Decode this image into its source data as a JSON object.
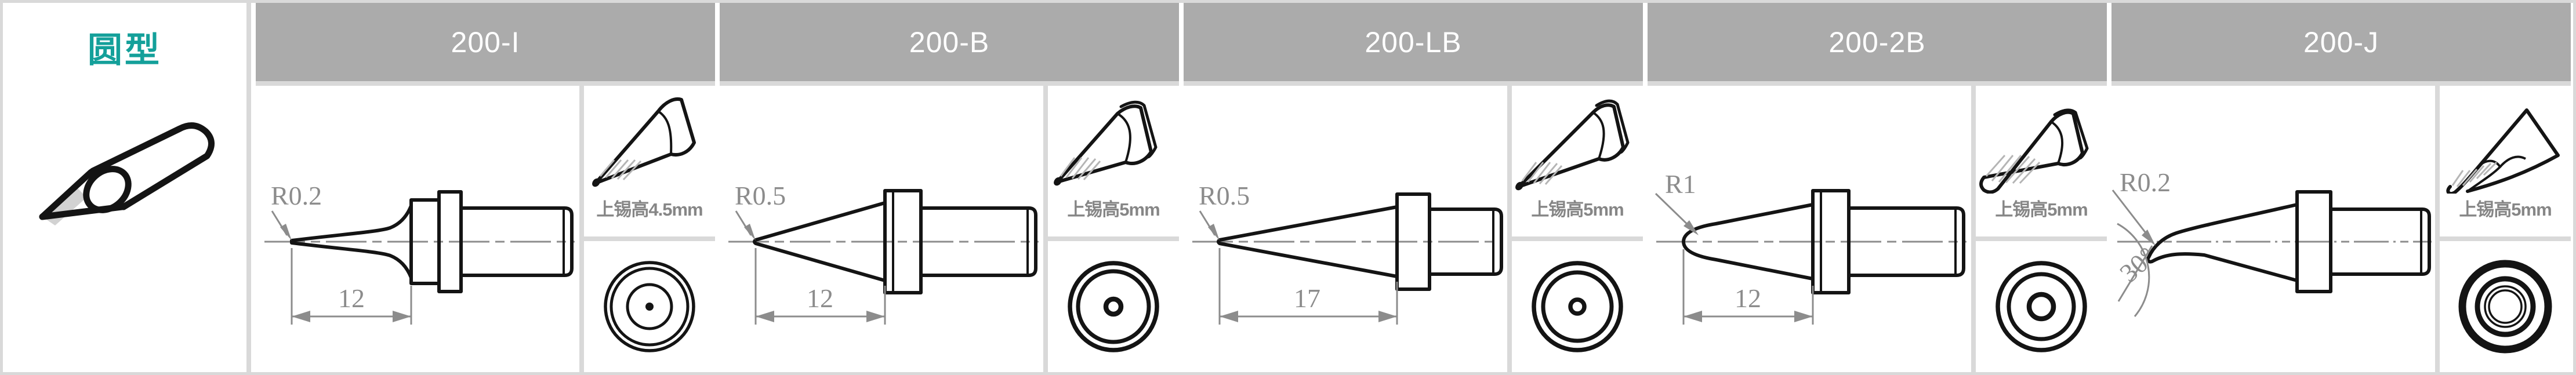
{
  "category": {
    "title": "圆型"
  },
  "colors": {
    "accent_teal": "#14a09a",
    "header_bg": "#ababab",
    "header_text": "#ffffff",
    "grid": "#d9d9d9",
    "drawing_line": "#141414",
    "annotation_gray": "#8c8c8c"
  },
  "columns": [
    {
      "model": "200-I",
      "radius_label": "R0.2",
      "length_label": "12",
      "tin_height_label": "上锡高4.5mm"
    },
    {
      "model": "200-B",
      "radius_label": "R0.5",
      "length_label": "12",
      "tin_height_label": "上锡高5mm"
    },
    {
      "model": "200-LB",
      "radius_label": "R0.5",
      "length_label": "17",
      "tin_height_label": "上锡高5mm"
    },
    {
      "model": "200-2B",
      "radius_label": "R1",
      "length_label": "12",
      "tin_height_label": "上锡高5mm"
    },
    {
      "model": "200-J",
      "radius_label": "R0.2",
      "angle_label": "30°",
      "tin_height_label": "上锡高5mm"
    }
  ]
}
